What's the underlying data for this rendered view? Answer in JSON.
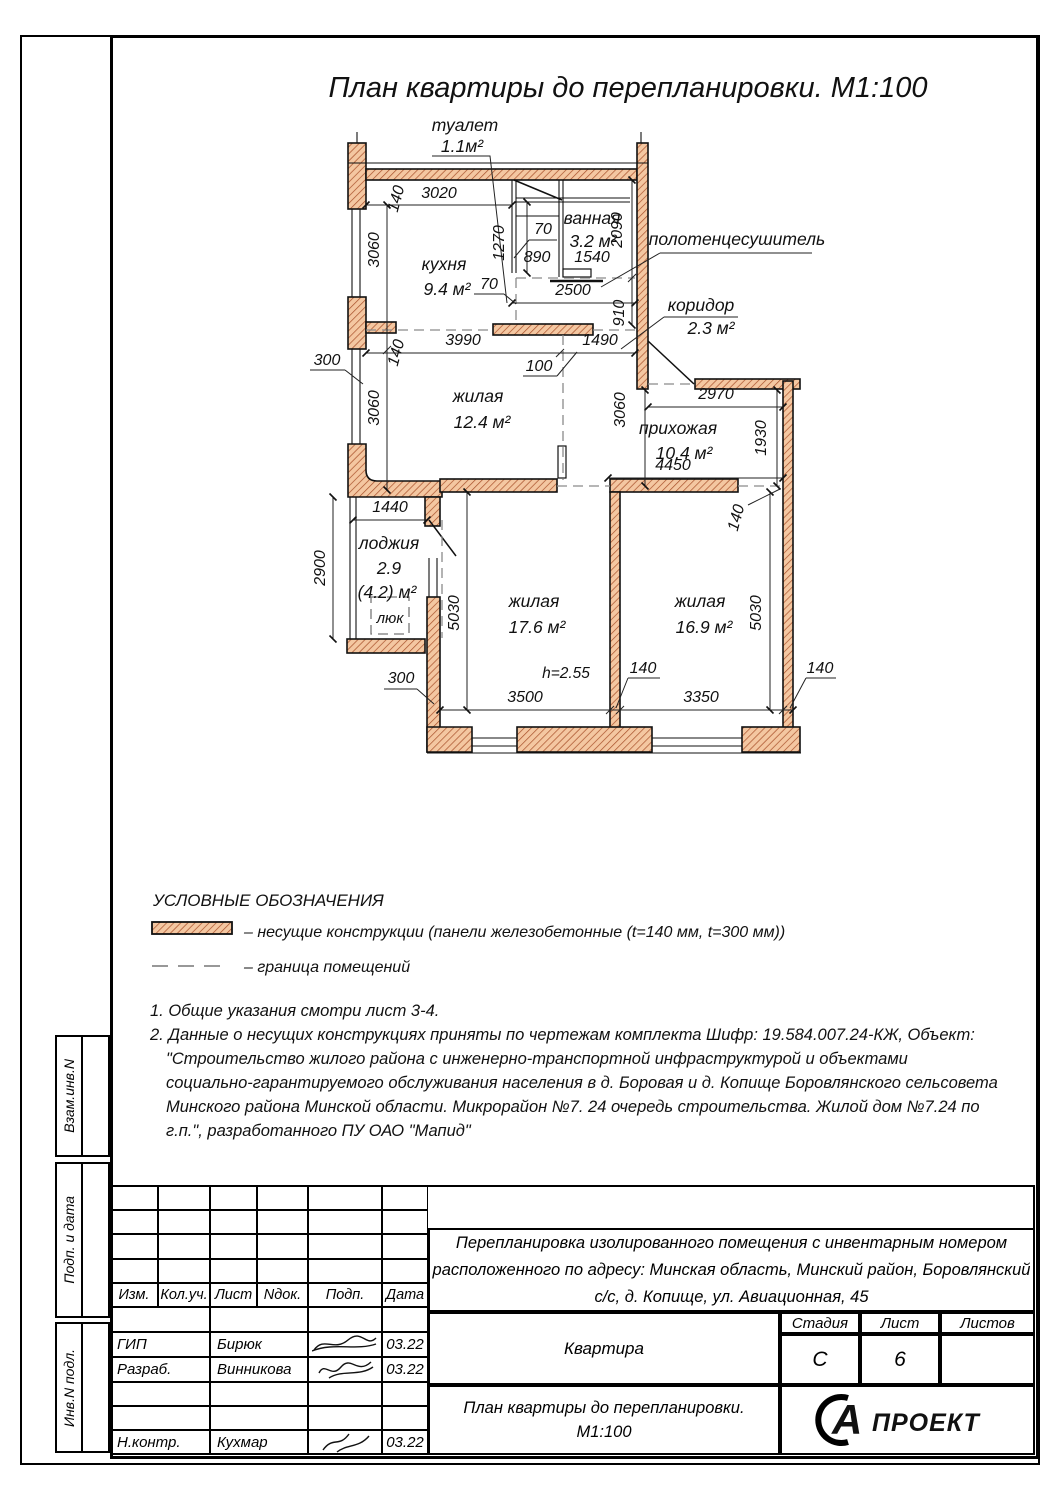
{
  "page_title": "План квартиры до перепланировки. М1:100",
  "rooms": {
    "toilet_name": "туалет",
    "toilet_area": "1.1м²",
    "bath_name": "ванная",
    "bath_area": "3.2 м²",
    "kitchen_name": "кухня",
    "kitchen_area": "9.4 м²",
    "corridor_name": "коридор",
    "corridor_area": "2.3 м²",
    "living1_name": "жилая",
    "living1_area": "12.4 м²",
    "hall_name": "прихожая",
    "hall_area": "10.4 м²",
    "loggia_name": "лоджия",
    "loggia_area1": "2.9",
    "loggia_area2": "(4.2) м²",
    "hatch_label": "люк",
    "living2_name": "жилая",
    "living2_area": "17.6 м²",
    "living3_name": "жилая",
    "living3_area": "16.9 м²",
    "towel": "полотенцесушитель",
    "height_note": "h=2.55"
  },
  "dims": {
    "d3020": "3020",
    "d140": "140",
    "d3060": "3060",
    "d1270": "1270",
    "d70": "70",
    "d890": "890",
    "d1540": "1540",
    "d2090": "2090",
    "d2500": "2500",
    "d910": "910",
    "d300": "300",
    "d3990": "3990",
    "d1490": "1490",
    "d100": "100",
    "d2970": "2970",
    "d1930": "1930",
    "d4450": "4450",
    "d1440": "1440",
    "d2900": "2900",
    "d5030": "5030",
    "d3500": "3500",
    "d3350": "3350"
  },
  "legend": {
    "heading": "УСЛОВНЫЕ ОБОЗНАЧЕНИЯ",
    "bearing": "– несущие конструкции (панели железобетонные  (t=140 мм, t=300 мм))",
    "boundary": "– граница помещений"
  },
  "notes": {
    "lines": [
      "1. Общие указания смотри лист 3-4.",
      "2. Данные о несущих конструкциях приняты по чертежам комплекта Шифр: 19.584.007.24-КЖ, Объект:",
      "\"Строительство жилого района с инженерно-транспортной инфраструктурой и объектами",
      "социально-гарантируемого обслуживания населения в д. Боровая и д. Копище Боровлянского сельсовета",
      "Минского района Минской области. Микрорайон №7. 24 очередь строительства. Жилой дом №7.24 по",
      "г.п.\", разработанного ПУ ОАО \"Мапид\""
    ]
  },
  "titleblock": {
    "doc_title": [
      "Перепланировка изолированного помещения с инвентарным номером",
      "расположенного по адресу: Минская область, Минский район, Боровлянский",
      "с/с, д. Копище, ул. Авиационная, 45"
    ],
    "object_name": "Квартира",
    "sheet_title": [
      "План квартиры до перепланировки.",
      "М1:100"
    ],
    "cols": [
      "Изм.",
      "Кол.уч.",
      "Лист",
      "Nдок.",
      "Подп.",
      "Дата"
    ],
    "stage_label": "Стадия",
    "sheet_label": "Лист",
    "sheets_label": "Листов",
    "stage": "С",
    "sheet_no": "6",
    "rows": [
      {
        "role": "ГИП",
        "name": "Бирюк",
        "date": "03.22"
      },
      {
        "role": "Разраб.",
        "name": "Винникова",
        "date": "03.22"
      },
      {
        "role": "Н.контр.",
        "name": "Кухмар",
        "date": "03.22"
      }
    ],
    "logo_letter": "А",
    "logo_word": "ПРОЕКТ"
  },
  "side_labels": {
    "top": "Взам.инв.N",
    "mid": "Подп. и дата",
    "bottom": "Инв.N подл."
  },
  "colors": {
    "wall_fill": "#f4c7a1",
    "wall_hatch": "#a8502a"
  }
}
